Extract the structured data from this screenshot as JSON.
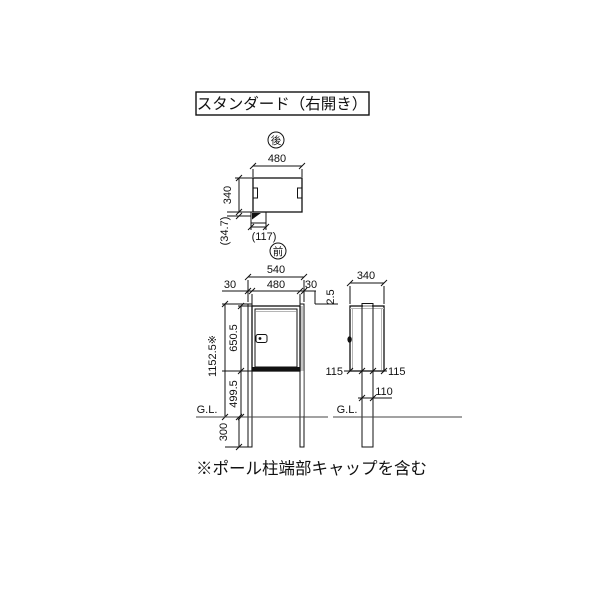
{
  "title": "スタンダード（右開き）",
  "note": "※ポール柱端部キャップを含む",
  "markers": {
    "rear": "後",
    "front": "前"
  },
  "top_view": {
    "width": "480",
    "depth": "340",
    "back_offset": "(34.7)",
    "pole_offset": "(117)"
  },
  "front_view": {
    "total_width": "540",
    "margin_left": "30",
    "box_width": "480",
    "margin_right": "30",
    "cap_height": "2.5",
    "box_height": "650.5",
    "total_height": "1152.5※",
    "under_box": "499.5",
    "embed_depth": "300",
    "ground_label": "G.L."
  },
  "side_view": {
    "depth": "340",
    "front_margin": "115",
    "rear_margin": "115",
    "pole_depth": "110",
    "ground_label": "G.L."
  },
  "colors": {
    "line": "#111111",
    "shade": "#c5c5c5",
    "ground": "#444444"
  }
}
